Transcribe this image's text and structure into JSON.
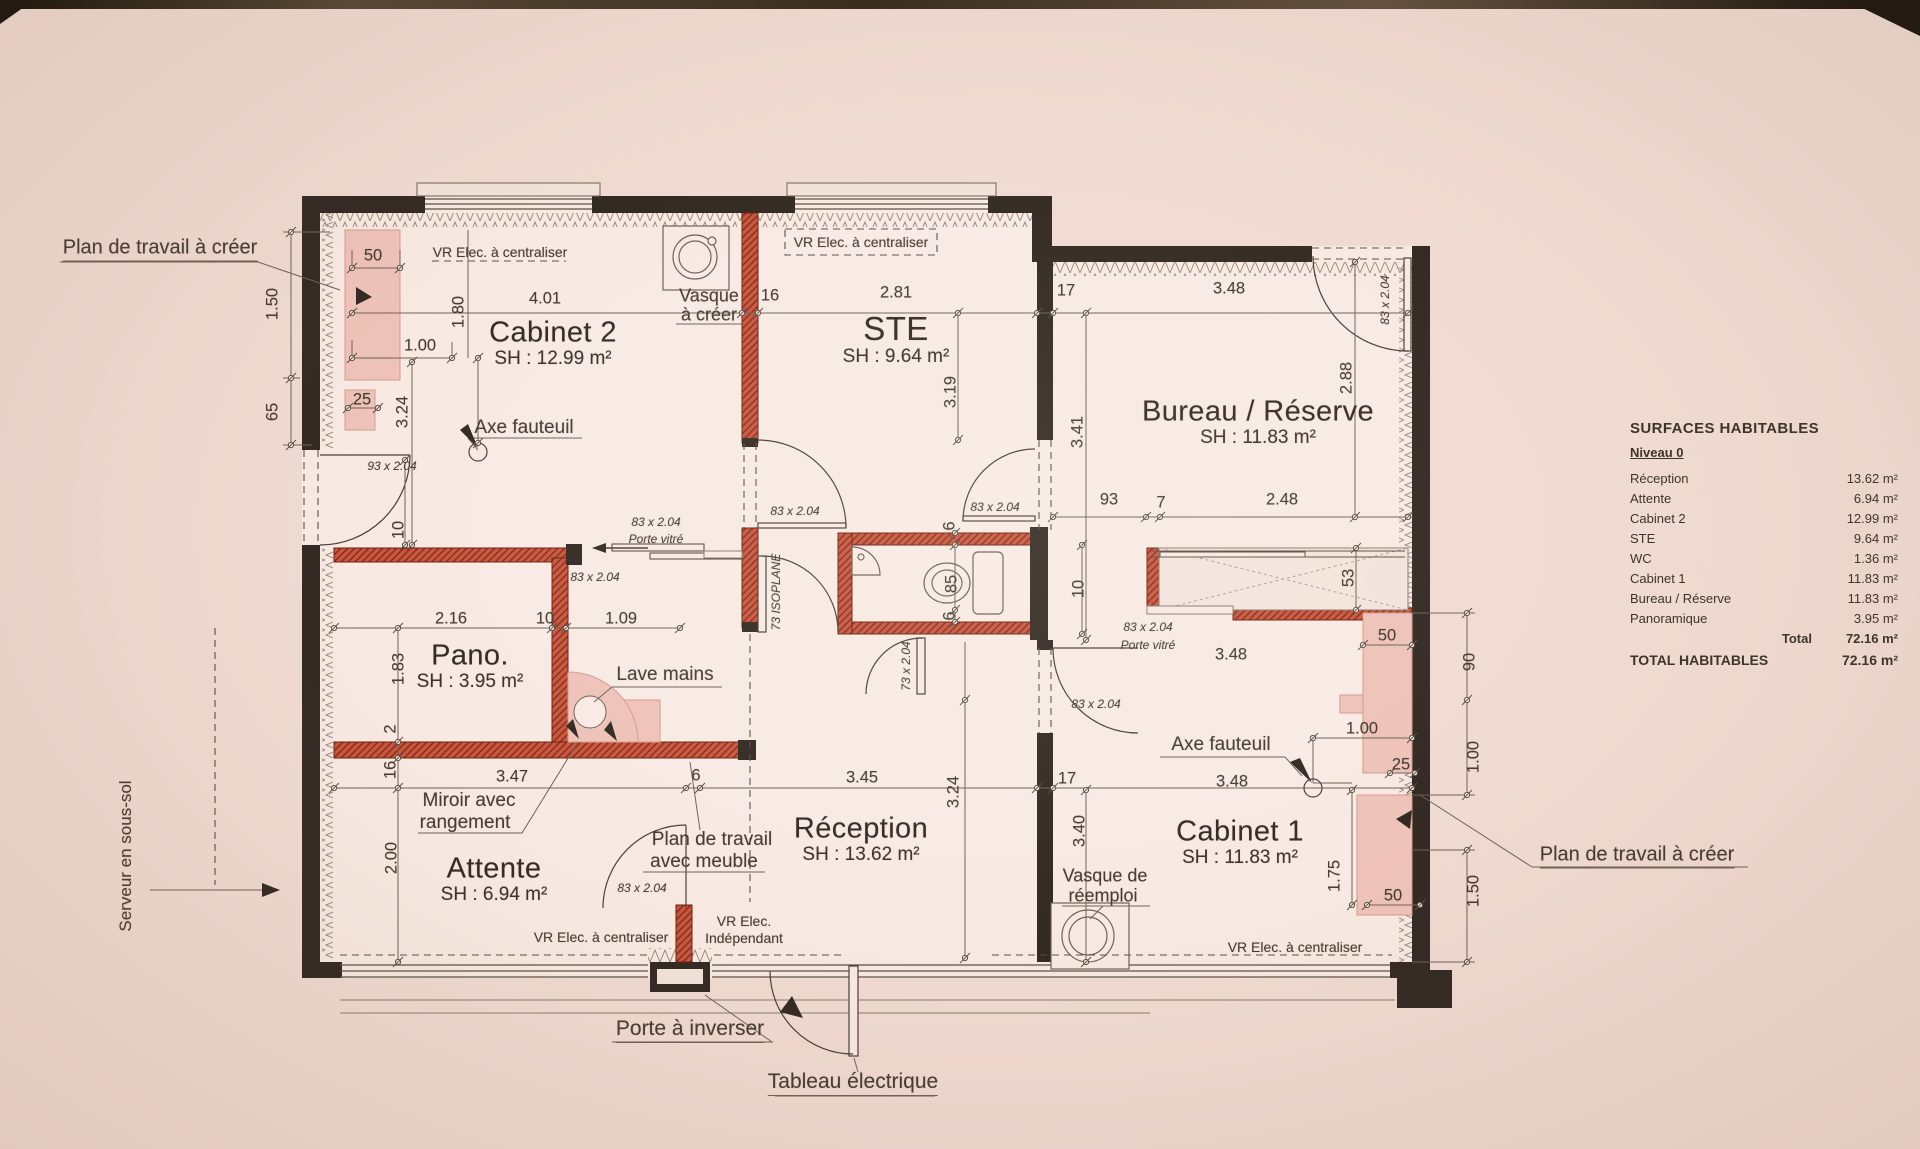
{
  "document": {
    "kind": "scanned architectural floor plan",
    "paper_color": "#f0dbd2",
    "room_color": "#f8eae3",
    "ink_color": "#332a23",
    "new_wall_color": "#c65740",
    "worktop_pink": "#eec3b9"
  },
  "rooms": [
    {
      "t": "Cabinet 2",
      "a": "SH : 12.99 m²",
      "x": 553,
      "y": 333
    },
    {
      "t": "STE",
      "a": "SH : 9.64 m²",
      "x": 896,
      "y": 329,
      "s": 33
    },
    {
      "t": "Bureau / Réserve",
      "a": "SH : 11.83 m²",
      "x": 1258,
      "y": 412
    },
    {
      "t": "Pano.",
      "a": "SH : 3.95 m²",
      "x": 470,
      "y": 656
    },
    {
      "t": "Attente",
      "a": "SH : 6.94 m²",
      "x": 494,
      "y": 869
    },
    {
      "t": "Réception",
      "a": "SH : 13.62 m²",
      "x": 861,
      "y": 829
    },
    {
      "t": "Cabinet 1",
      "a": "SH : 11.83 m²",
      "x": 1240,
      "y": 832
    }
  ],
  "dimensions": [
    {
      "t": "1.50",
      "x": 273,
      "y": 304,
      "r": 1
    },
    {
      "t": "65",
      "x": 273,
      "y": 412,
      "r": 1
    },
    {
      "t": "50",
      "x": 373,
      "y": 256
    },
    {
      "t": "1.00",
      "x": 420,
      "y": 346
    },
    {
      "t": "25",
      "x": 362,
      "y": 400
    },
    {
      "t": "3.24",
      "x": 403,
      "y": 412,
      "r": 1
    },
    {
      "t": "1.80",
      "x": 459,
      "y": 312,
      "r": 1
    },
    {
      "t": "4.01",
      "x": 545,
      "y": 299
    },
    {
      "t": "16",
      "x": 770,
      "y": 296
    },
    {
      "t": "2.81",
      "x": 896,
      "y": 293
    },
    {
      "t": "3.19",
      "x": 951,
      "y": 392,
      "r": 1
    },
    {
      "t": "17",
      "x": 1066,
      "y": 291
    },
    {
      "t": "3.48",
      "x": 1229,
      "y": 289
    },
    {
      "t": "2.88",
      "x": 1347,
      "y": 378,
      "r": 1
    },
    {
      "t": "3.41",
      "x": 1078,
      "y": 432,
      "r": 1
    },
    {
      "t": "93",
      "x": 1109,
      "y": 500
    },
    {
      "t": "7",
      "x": 1161,
      "y": 503
    },
    {
      "t": "2.48",
      "x": 1282,
      "y": 500
    },
    {
      "t": "53",
      "x": 1349,
      "y": 578,
      "r": 1
    },
    {
      "t": "50",
      "x": 1387,
      "y": 636
    },
    {
      "t": "90",
      "x": 1470,
      "y": 662,
      "r": 1
    },
    {
      "t": "3.48",
      "x": 1231,
      "y": 655
    },
    {
      "t": "1.00",
      "x": 1362,
      "y": 729
    },
    {
      "t": "25",
      "x": 1401,
      "y": 765
    },
    {
      "t": "3.48",
      "x": 1232,
      "y": 782
    },
    {
      "t": "1.00",
      "x": 1474,
      "y": 757,
      "r": 1
    },
    {
      "t": "17",
      "x": 1067,
      "y": 779
    },
    {
      "t": "3.40",
      "x": 1080,
      "y": 831,
      "r": 1
    },
    {
      "t": "1.75",
      "x": 1335,
      "y": 876,
      "r": 1
    },
    {
      "t": "50",
      "x": 1393,
      "y": 896
    },
    {
      "t": "1.50",
      "x": 1474,
      "y": 891,
      "r": 1
    },
    {
      "t": "10",
      "x": 399,
      "y": 530,
      "r": 1
    },
    {
      "t": "2.16",
      "x": 451,
      "y": 619
    },
    {
      "t": "10",
      "x": 545,
      "y": 619
    },
    {
      "t": "1.09",
      "x": 621,
      "y": 619
    },
    {
      "t": "1.83",
      "x": 399,
      "y": 669,
      "r": 1
    },
    {
      "t": "2",
      "x": 391,
      "y": 729,
      "r": 1
    },
    {
      "t": "16",
      "x": 391,
      "y": 770,
      "r": 1
    },
    {
      "t": "3.47",
      "x": 512,
      "y": 777
    },
    {
      "t": "2.00",
      "x": 392,
      "y": 858,
      "r": 1
    },
    {
      "t": "6",
      "x": 696,
      "y": 776
    },
    {
      "t": "3.45",
      "x": 862,
      "y": 778
    },
    {
      "t": "3.24",
      "x": 954,
      "y": 792,
      "r": 1
    },
    {
      "t": "85",
      "x": 952,
      "y": 584,
      "r": 1
    },
    {
      "t": "6",
      "x": 950,
      "y": 526,
      "r": 1
    },
    {
      "t": "6",
      "x": 950,
      "y": 616,
      "r": 1
    },
    {
      "t": "10",
      "x": 1079,
      "y": 589,
      "r": 1
    }
  ],
  "door_labels": [
    {
      "t": "93 x 2.04",
      "x": 392,
      "y": 466
    },
    {
      "t": "83 x 2.04",
      "x": 656,
      "y": 522
    },
    {
      "t": "Porte vitré",
      "x": 656,
      "y": 539
    },
    {
      "t": "83 x 2.04",
      "x": 595,
      "y": 577
    },
    {
      "t": "83 x 2.04",
      "x": 795,
      "y": 511
    },
    {
      "t": "73 ISOPLANE",
      "x": 776,
      "y": 592,
      "r": 1
    },
    {
      "t": "73 x 2.04",
      "x": 906,
      "y": 666,
      "r": 1
    },
    {
      "t": "83 x 2.04",
      "x": 1385,
      "y": 300,
      "r": 1
    },
    {
      "t": "83 x 2.04",
      "x": 995,
      "y": 507
    },
    {
      "t": "83 x 2.04",
      "x": 1148,
      "y": 627
    },
    {
      "t": "Porte vitré",
      "x": 1148,
      "y": 645
    },
    {
      "t": "83 x 2.04",
      "x": 1096,
      "y": 704
    },
    {
      "t": "83 x 2.04",
      "x": 642,
      "y": 888
    }
  ],
  "annotations": [
    {
      "t": "Plan de travail à créer",
      "x": 160,
      "y": 249,
      "s": 20,
      "u": 1
    },
    {
      "t": "VR Elec. à centraliser",
      "x": 500,
      "y": 252,
      "s": 14
    },
    {
      "t": "VR Elec. à centraliser",
      "x": 861,
      "y": 242,
      "s": 14
    },
    {
      "t": "Vasque",
      "x": 709,
      "y": 296,
      "s": 18
    },
    {
      "t": "à créer",
      "x": 709,
      "y": 315,
      "s": 18
    },
    {
      "t": "Axe fauteuil",
      "x": 524,
      "y": 428
    },
    {
      "t": "Lave mains",
      "x": 665,
      "y": 675
    },
    {
      "t": "Miroir avec",
      "x": 469,
      "y": 801
    },
    {
      "t": "rangement",
      "x": 465,
      "y": 823
    },
    {
      "t": "Plan de travail",
      "x": 712,
      "y": 840
    },
    {
      "t": "avec meuble",
      "x": 704,
      "y": 862
    },
    {
      "t": "Axe fauteuil",
      "x": 1221,
      "y": 745
    },
    {
      "t": "Vasque de",
      "x": 1105,
      "y": 876,
      "s": 18
    },
    {
      "t": "réemploi",
      "x": 1103,
      "y": 896,
      "s": 18
    },
    {
      "t": "VR Elec. à centraliser",
      "x": 601,
      "y": 937,
      "s": 14
    },
    {
      "t": "VR Elec.",
      "x": 744,
      "y": 921,
      "s": 14
    },
    {
      "t": "Indépendant",
      "x": 744,
      "y": 938,
      "s": 14
    },
    {
      "t": "VR Elec. à centraliser",
      "x": 1295,
      "y": 947,
      "s": 14
    },
    {
      "t": "Porte à inverser",
      "x": 690,
      "y": 1030,
      "s": 21,
      "u": 1
    },
    {
      "t": "Tableau électrique",
      "x": 853,
      "y": 1083,
      "s": 21,
      "u": 1
    },
    {
      "t": "Plan de travail à créer",
      "x": 1637,
      "y": 856,
      "s": 20,
      "u": 1
    },
    {
      "t": "Serveur en sous-sol",
      "x": 126,
      "y": 856,
      "s": 17,
      "r": 1
    }
  ],
  "surfaces_table": {
    "title": "SURFACES HABITABLES",
    "level": "Niveau 0",
    "rows": [
      {
        "label": "Réception",
        "value": "13.62 m²"
      },
      {
        "label": "Attente",
        "value": "6.94 m²"
      },
      {
        "label": "Cabinet 2",
        "value": "12.99 m²"
      },
      {
        "label": "STE",
        "value": "9.64 m²"
      },
      {
        "label": "WC",
        "value": "1.36 m²"
      },
      {
        "label": "Cabinet 1",
        "value": "11.83 m²"
      },
      {
        "label": "Bureau / Réserve",
        "value": "11.83 m²"
      },
      {
        "label": "Panoramique",
        "value": "3.95 m²"
      }
    ],
    "total_label": "Total",
    "total_value": "72.16 m²",
    "grand_total_label": "TOTAL HABITABLES",
    "grand_total_value": "72.16 m²"
  }
}
